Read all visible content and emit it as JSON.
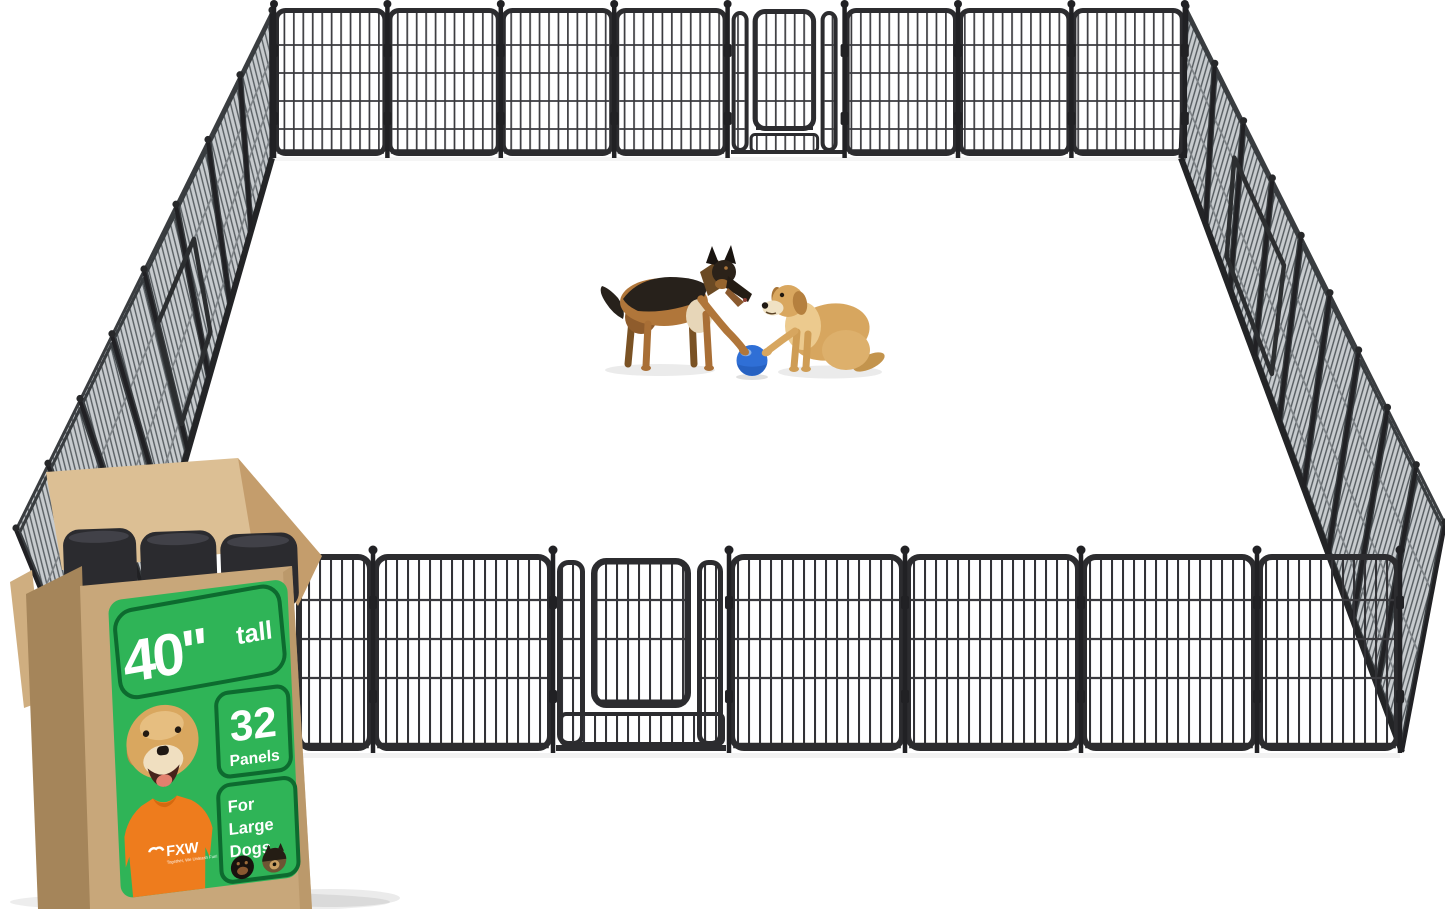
{
  "product_label": {
    "height_value": "40\"",
    "height_suffix": "tall",
    "panel_count": "32",
    "panel_count_label": "Panels",
    "audience_line1": "For",
    "audience_line2": "Large",
    "audience_line3": "Dogs",
    "label_color": "#2fb457",
    "label_outline_color": "#0d6b2f"
  },
  "brand": {
    "name": "FXW",
    "tagline": "Together, We Unleash Fun!"
  },
  "packaging": {
    "box_color": "#c8a77a",
    "box_side_color": "#a5855a",
    "flap_color": "#dcbf94",
    "contents": "folded-black-metal-panels"
  },
  "scene": {
    "background_color": "#ffffff",
    "fence_color": "#2c2c2f",
    "oblique_panel_color": "#c7cbce",
    "ball_color": "#2f6fd6",
    "shirt_color": "#ee7c1d",
    "center_animals": [
      "german-shepherd",
      "golden-retriever"
    ],
    "label_photo_dogs": [
      "golden-retriever",
      "rottweiler",
      "german-shepherd"
    ]
  }
}
